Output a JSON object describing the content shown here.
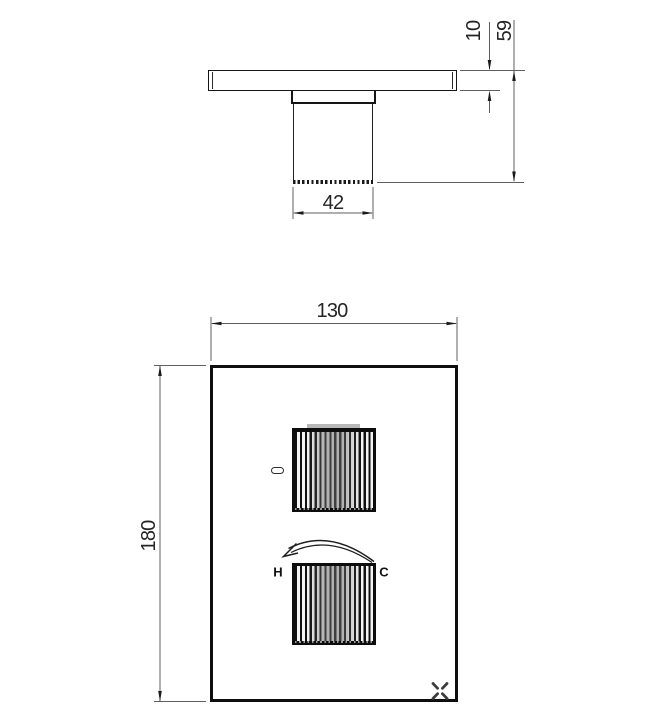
{
  "drawing": {
    "type": "technical-drawing",
    "subject": "thermostatic shower valve trim plate with two knurled control knobs",
    "colors": {
      "background": "#ffffff",
      "object_line": "#161616",
      "dimension_line": "#5f5f5f",
      "dimension_text": "#242424"
    },
    "side_view": {
      "dimensions": {
        "plate_thickness": "10",
        "total_depth": "59",
        "knob_diameter": "42"
      }
    },
    "front_view": {
      "dimensions": {
        "plate_width": "130",
        "plate_height": "180"
      },
      "labels": {
        "hot": "H",
        "cold": "C"
      },
      "icons": {
        "rotation_arrow": "curved-arrow-counter-clockwise",
        "brand_mark": "x-cross-logo"
      }
    }
  }
}
